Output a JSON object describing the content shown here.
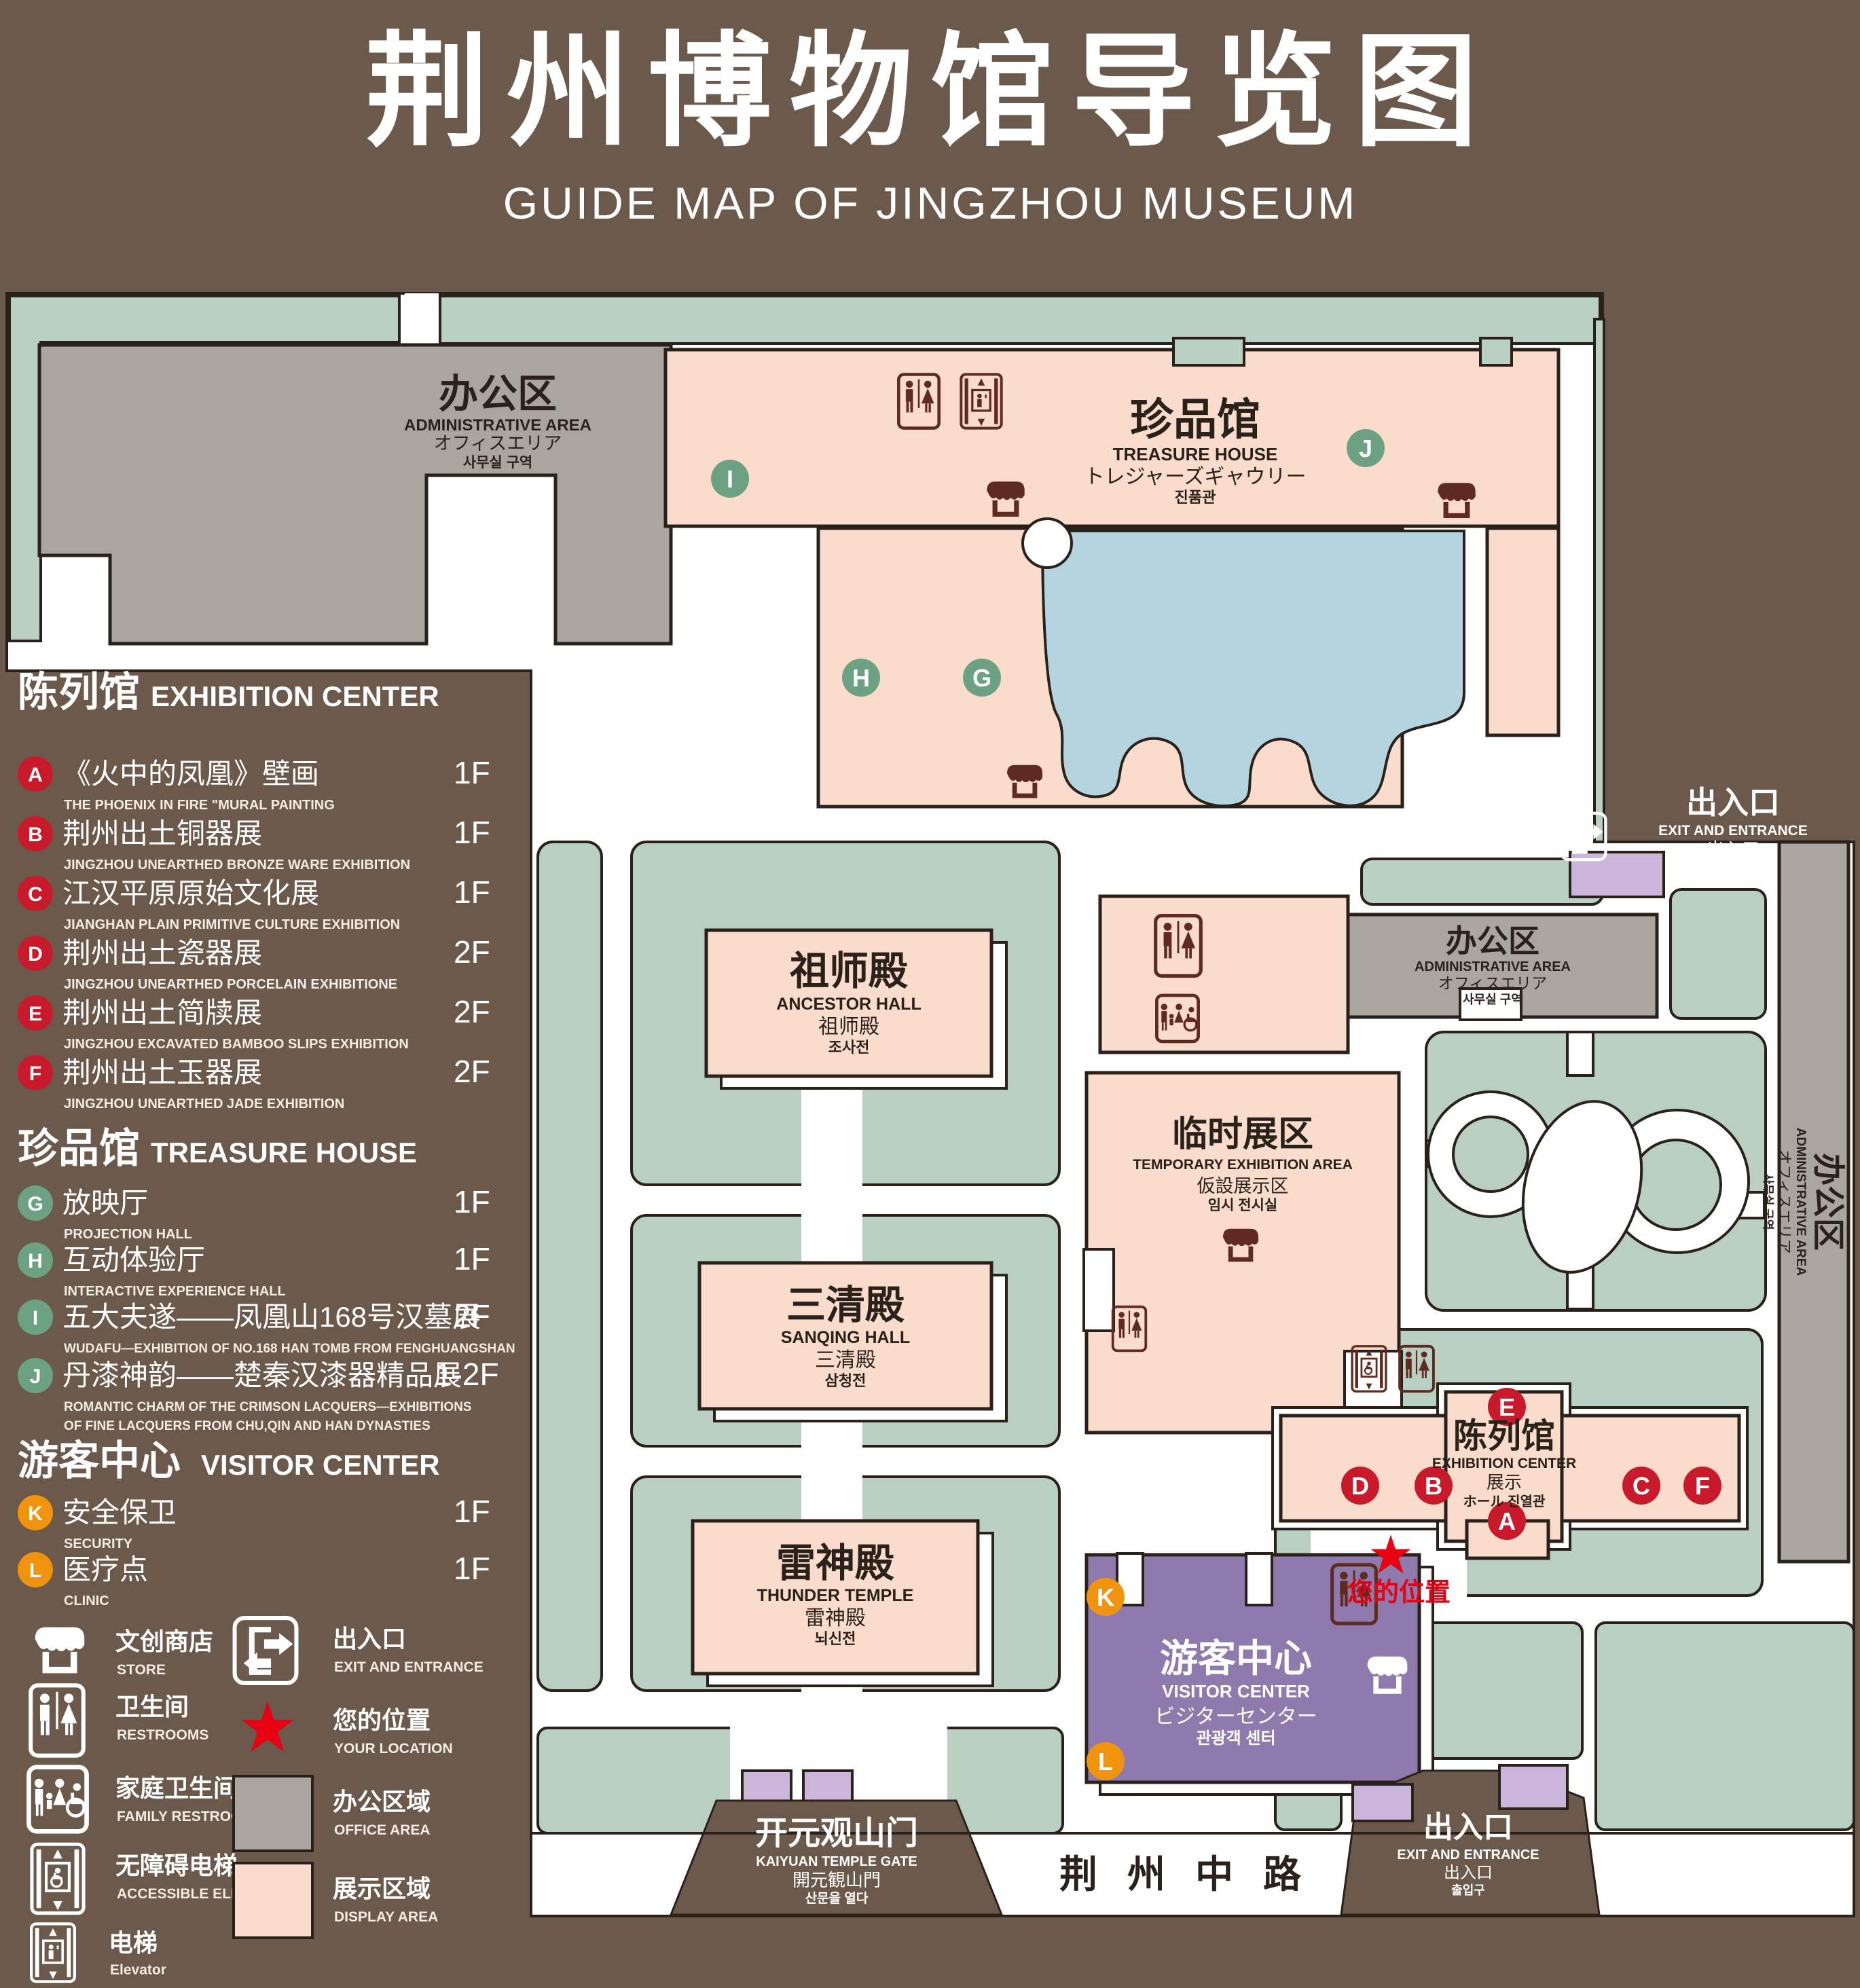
{
  "title": {
    "cn": "荆州博物馆导览图",
    "en": "GUIDE MAP OF JINGZHOU MUSEUM"
  },
  "colors": {
    "poster_brown": "#6b594b",
    "map_white": "#ffffff",
    "lawn_green": "#b9cfc2",
    "display_pink": "#f9dccb",
    "office_gray": "#aba5a0",
    "lake_blue": "#b4d4e0",
    "visitor_purple": "#8e7aac",
    "gate_lilac": "#c9b6da",
    "icon_maroon": "#5f2b20",
    "badge_red": "#c91a2b",
    "badge_green": "#6ca183",
    "badge_orange": "#f0930f",
    "location_red": "#e60012",
    "outline_dark": "#2b211b"
  },
  "legend": {
    "sections": [
      {
        "head_cn": "陈列馆",
        "head_en": "EXHIBITION CENTER",
        "items": [
          {
            "letter": "A",
            "cn": "《火中的凤凰》壁画",
            "en": "THE PHOENIX IN FIRE \"MURAL PAINTING",
            "floor": "1F"
          },
          {
            "letter": "B",
            "cn": "荆州出土铜器展",
            "en": "JINGZHOU UNEARTHED BRONZE WARE EXHIBITION",
            "floor": "1F"
          },
          {
            "letter": "C",
            "cn": "江汉平原原始文化展",
            "en": "JIANGHAN PLAIN PRIMITIVE CULTURE EXHIBITION",
            "floor": "1F"
          },
          {
            "letter": "D",
            "cn": "荆州出土瓷器展",
            "en": "JINGZHOU UNEARTHED PORCELAIN EXHIBITIONE",
            "floor": "2F"
          },
          {
            "letter": "E",
            "cn": "荆州出土简牍展",
            "en": "JINGZHOU EXCAVATED BAMBOO SLIPS EXHIBITION",
            "floor": "2F"
          },
          {
            "letter": "F",
            "cn": "荆州出土玉器展",
            "en": "JINGZHOU UNEARTHED JADE EXHIBITION",
            "floor": "2F"
          }
        ]
      },
      {
        "head_cn": "珍品馆",
        "head_en": "TREASURE HOUSE",
        "items": [
          {
            "letter": "G",
            "cn": "放映厅",
            "en": "PROJECTION HALL",
            "floor": "1F"
          },
          {
            "letter": "H",
            "cn": "互动体验厅",
            "en": "INTERACTIVE EXPERIENCE HALL",
            "floor": "1F"
          },
          {
            "letter": "I",
            "cn": "五大夫遂——凤凰山168号汉墓展",
            "en": "WUDAFU—EXHIBITION OF NO.168 HAN TOMB FROM FENGHUANGSHAN",
            "floor": "2F"
          },
          {
            "letter": "J",
            "cn": "丹漆神韵——楚秦汉漆器精品展",
            "en": "ROMANTIC CHARM OF THE CRIMSON LACQUERS—EXHIBITIONS",
            "en2": "OF FINE LACQUERS FROM CHU,QIN AND HAN DYNASTIES",
            "floor": "1-2F"
          }
        ]
      },
      {
        "head_cn": "游客中心",
        "head_en": "VISITOR CENTER",
        "items": [
          {
            "letter": "K",
            "cn": "安全保卫",
            "en": "SECURITY",
            "floor": "1F"
          },
          {
            "letter": "L",
            "cn": "医疗点",
            "en": "CLINIC",
            "floor": "1F"
          }
        ]
      }
    ],
    "symbols": {
      "store": {
        "cn": "文创商店",
        "en": "STORE"
      },
      "restrooms": {
        "cn": "卫生间",
        "en": "RESTROOMS"
      },
      "family": {
        "cn": "家庭卫生间",
        "en": "FAMILY RESTROOMS"
      },
      "accessible": {
        "cn": "无障碍电梯",
        "en": "ACCESSIBLE ELEVATOR"
      },
      "elevator": {
        "cn": "电梯",
        "en": "Elevator"
      },
      "exit": {
        "cn": "出入口",
        "en": "EXIT AND ENTRANCE"
      },
      "location": {
        "cn": "您的位置",
        "en": "YOUR LOCATION"
      },
      "office": {
        "cn": "办公区域",
        "en": "OFFICE AREA"
      },
      "display": {
        "cn": "展示区域",
        "en": "DISPLAY AREA"
      }
    }
  },
  "map": {
    "admin": {
      "cn": "办公区",
      "en": "ADMINISTRATIVE AREA",
      "jp": "オフィスエリア",
      "kr": "사무실 구역"
    },
    "treasure": {
      "cn": "珍品馆",
      "en": "TREASURE HOUSE",
      "jp": "トレジャーズギャウリー",
      "kr": "진품관"
    },
    "ancestor": {
      "cn": "祖师殿",
      "en": "ANCESTOR HALL",
      "jp": "祖师殿",
      "kr": "조사전"
    },
    "temp": {
      "cn": "临时展区",
      "en": "TEMPORARY EXHIBITION AREA",
      "jp": "仮設展示区",
      "kr": "임시 전시실"
    },
    "sanqing": {
      "cn": "三清殿",
      "en": "SANQING HALL",
      "jp": "三清殿",
      "kr": "삼청전"
    },
    "thunder": {
      "cn": "雷神殿",
      "en": "THUNDER TEMPLE",
      "jp": "雷神殿",
      "kr": "뇌신전"
    },
    "visitor": {
      "cn": "游客中心",
      "en": "VISITOR CENTER",
      "jp": "ビジターセンター",
      "kr": "관광객 센터"
    },
    "exhibition": {
      "cn": "陈列馆",
      "en": "EXHIBITION CENTER",
      "line3": "展示",
      "line4": "ホール 진열관"
    },
    "exit": {
      "cn": "出入口",
      "en": "EXIT AND ENTRANCE",
      "cn2": "出入口",
      "kr": "출입구"
    },
    "gate": {
      "cn": "开元观山门",
      "en": "KAIYUAN TEMPLE GATE",
      "jp": "開元観山門",
      "kr": "산문을 열다"
    },
    "road": "荆州中路",
    "your_location": "您的位置"
  }
}
